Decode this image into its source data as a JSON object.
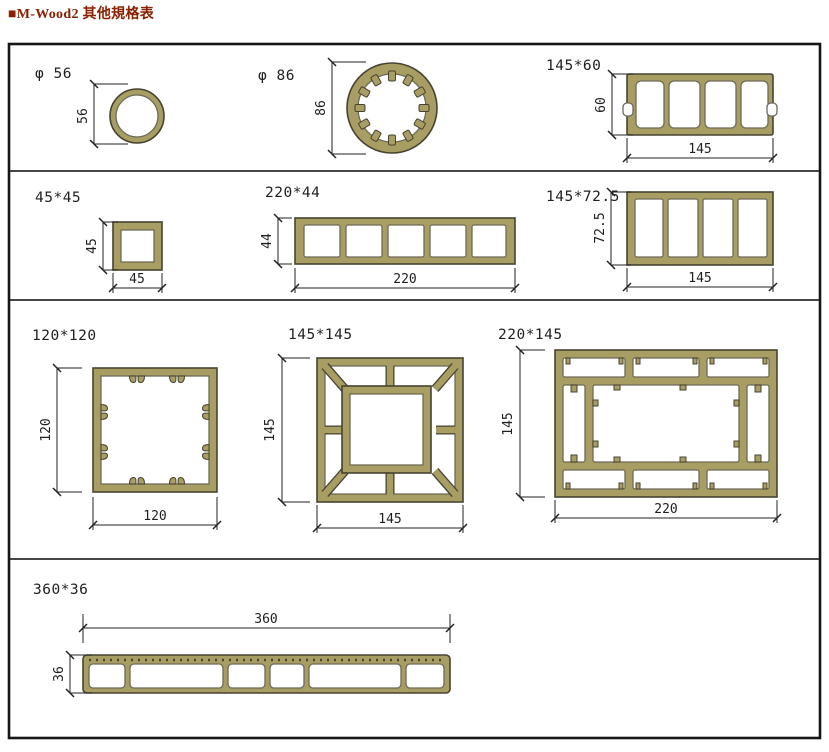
{
  "title": "■M-Wood2 其他規格表",
  "colors": {
    "title_color": "#8b2000",
    "profile_fill": "#a89d62",
    "profile_stroke": "#474431",
    "hole_stroke": "#6e6a58"
  },
  "panels": {
    "d56": {
      "label": "φ 56",
      "dim_v": "56"
    },
    "d86": {
      "label": "φ 86",
      "dim_v": "86"
    },
    "p145x60": {
      "label": "145*60",
      "dim_v": "60",
      "dim_h": "145"
    },
    "p45x45": {
      "label": "45*45",
      "dim_v": "45",
      "dim_h": "45"
    },
    "p220x44": {
      "label": "220*44",
      "dim_v": "44",
      "dim_h": "220"
    },
    "p145x725": {
      "label": "145*72.5",
      "dim_v": "72.5",
      "dim_h": "145"
    },
    "p120x120": {
      "label": "120*120",
      "dim_v": "120",
      "dim_h": "120"
    },
    "p145x145": {
      "label": "145*145",
      "dim_v": "145",
      "dim_h": "145"
    },
    "p220x145": {
      "label": "220*145",
      "dim_v": "145",
      "dim_h": "220"
    },
    "p360x36": {
      "label": "360*36",
      "dim_v": "36",
      "dim_h": "360"
    }
  }
}
